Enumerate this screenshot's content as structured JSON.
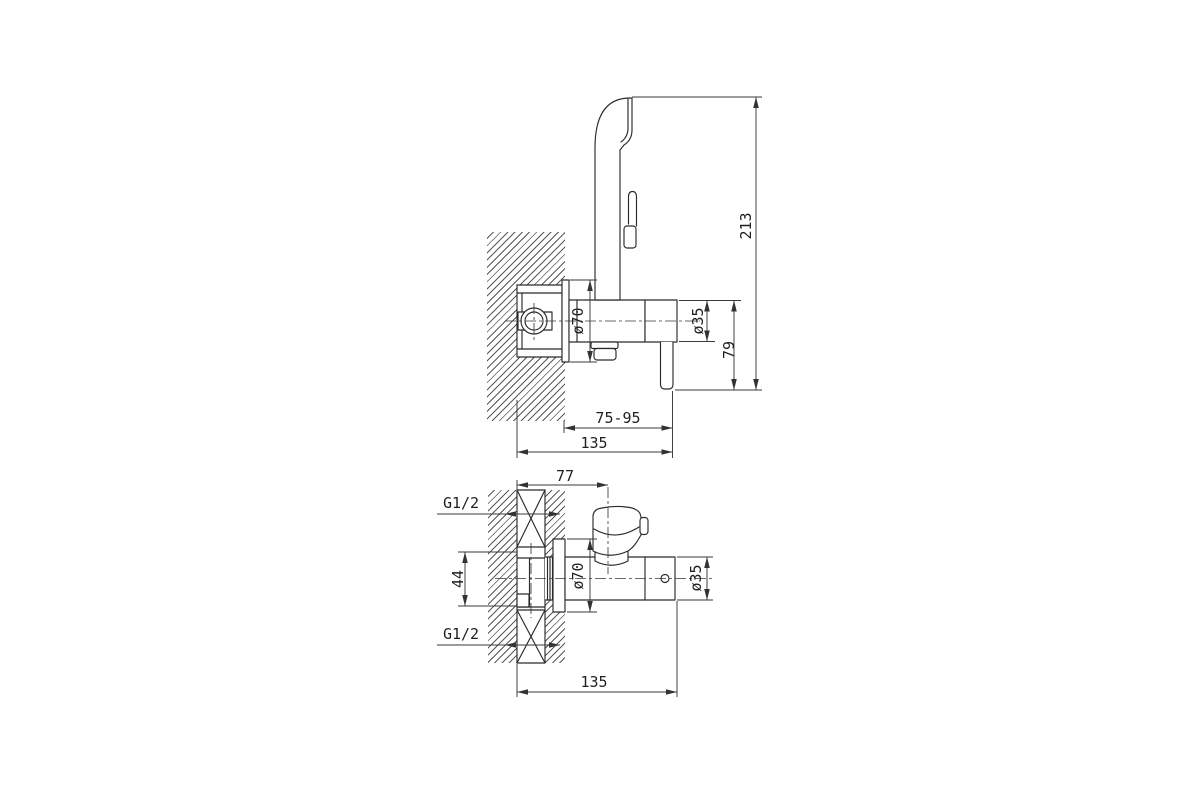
{
  "colors": {
    "line": "#2b2b2b",
    "dimension": "#3a3a3a",
    "text": "#1f1f1f",
    "hatch": "#585858",
    "background": "#ffffff"
  },
  "side_view": {
    "total_height": "213",
    "lever_drop": "79",
    "flange_diameter": "ø70",
    "body_diameter": "ø35",
    "depth_range": "75-95",
    "total_depth": "135"
  },
  "plan_view": {
    "head_offset": "77",
    "thread_size_top": "G1/2",
    "body_width": "44",
    "thread_size_bottom": "G1/2",
    "flange_diameter": "ø70",
    "body_diameter": "ø35",
    "total_length": "135"
  }
}
